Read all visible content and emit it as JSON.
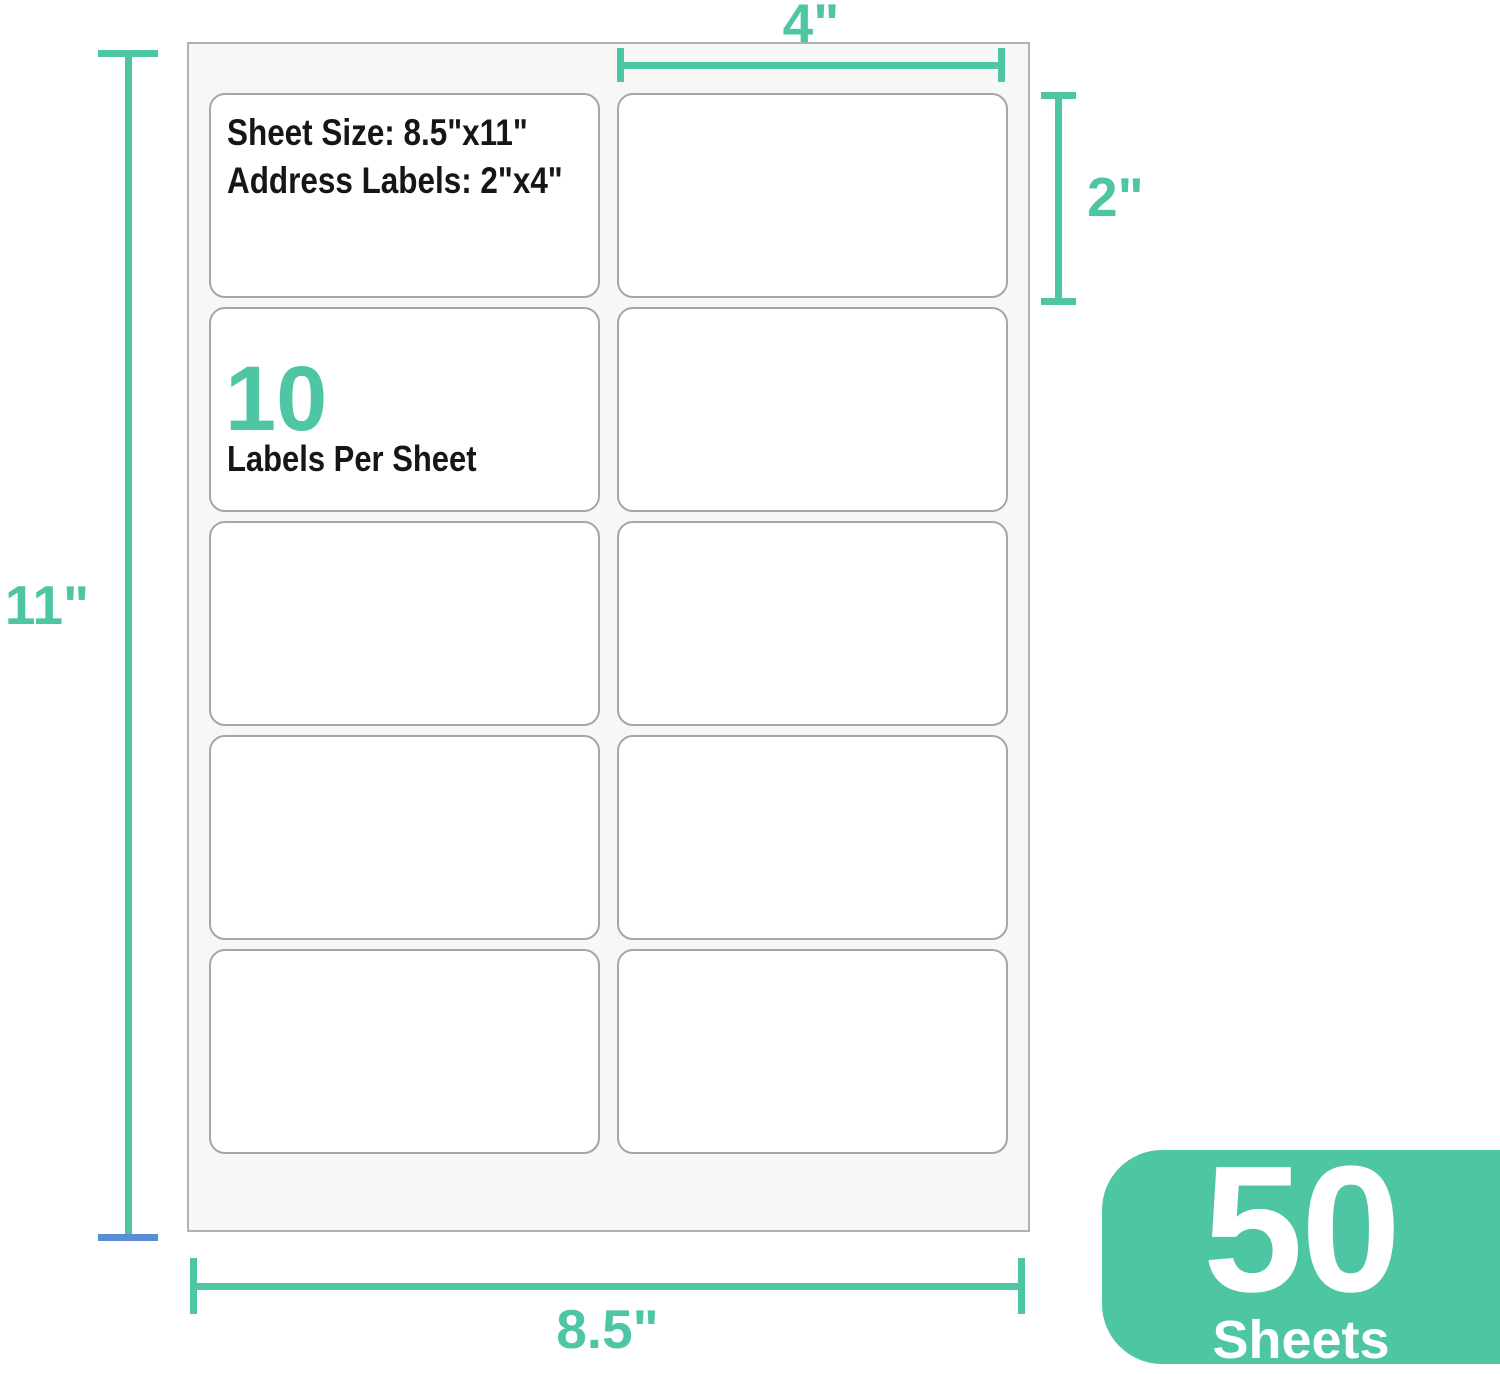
{
  "colors": {
    "accent_teal": "#4ec6a4",
    "tick_blue": "#5b8ed6",
    "sheet_fill": "#f7f7f7",
    "sheet_border": "#b1b1b1",
    "label_border": "#a6a6a6"
  },
  "sheet": {
    "spec_line1": "Sheet Size: 8.5\"x11\"",
    "spec_line2": "Address Labels: 2\"x4\"",
    "count_number": "10",
    "count_label": "Labels Per Sheet",
    "labels_per_sheet": 10,
    "grid": {
      "columns": 2,
      "rows": 5
    }
  },
  "dimensions": {
    "label_width": "4\"",
    "label_height": "2\"",
    "sheet_height": "11\"",
    "sheet_width": "8.5\""
  },
  "badge": {
    "number": "50",
    "label": "Sheets"
  }
}
